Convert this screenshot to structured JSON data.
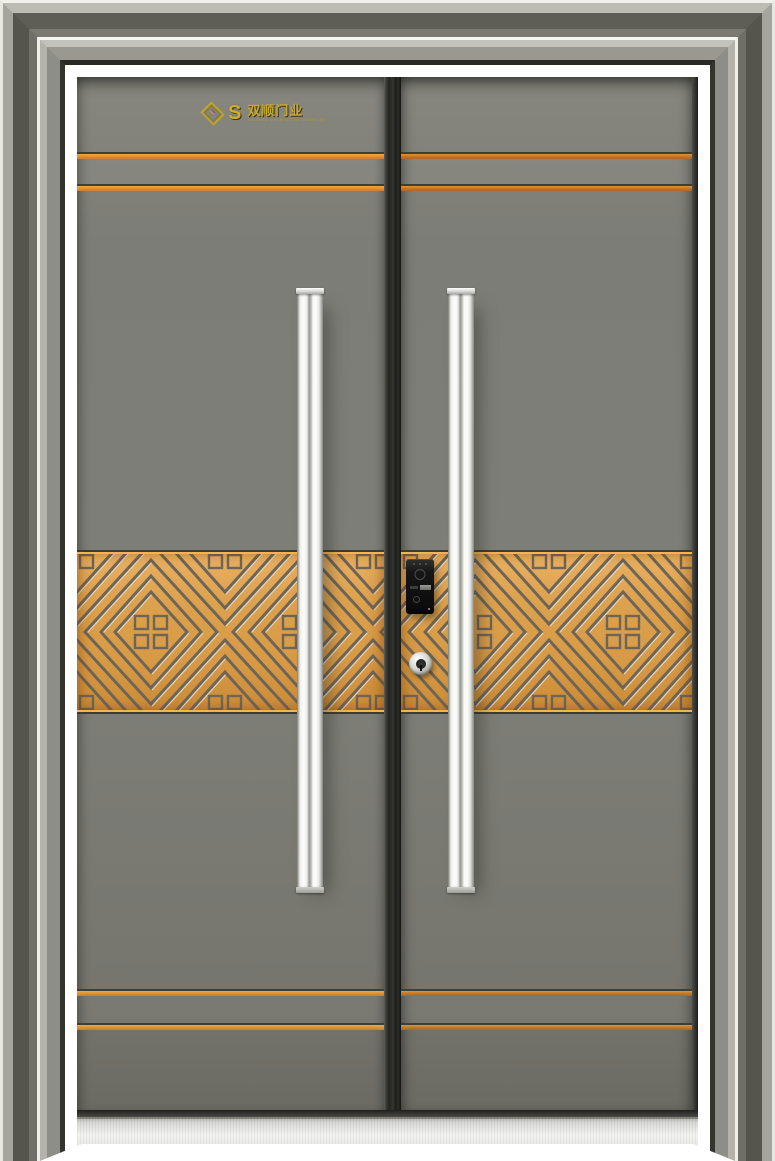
{
  "scene": {
    "type": "product-photo",
    "subject": "Double-leaf steel security entry door with golden decorative band",
    "floor_color": "#ffffff"
  },
  "brand": {
    "symbol": "S",
    "name": "双顺门业",
    "subtitle": "SHUANG SHUN DOOR INDUSTRY",
    "diamond_icon": "gold-diamond-badge"
  },
  "palette": {
    "door_panel": "#7f7f79",
    "frame_light": "#b3b3ac",
    "frame_dark": "#55554d",
    "frame_highlight": "#eeeeea",
    "accent_line": "#ee9f3d",
    "band_base": "#dda24e",
    "band_groove": "#6e6559",
    "band_highlight": "#e3d6bd",
    "handle": "#f3f3f1",
    "lock_body": "#141414",
    "keyhole_ring": "#c6c6c2",
    "threshold": "#e4e4e1",
    "logo_gold": "#c9a82e",
    "astragal": "#232320"
  },
  "hardware": {
    "handle_count": 2,
    "lock_type": "smart-lock-panel",
    "keyhole": "cylinder-keyhole",
    "sill": "stainless-threshold"
  }
}
